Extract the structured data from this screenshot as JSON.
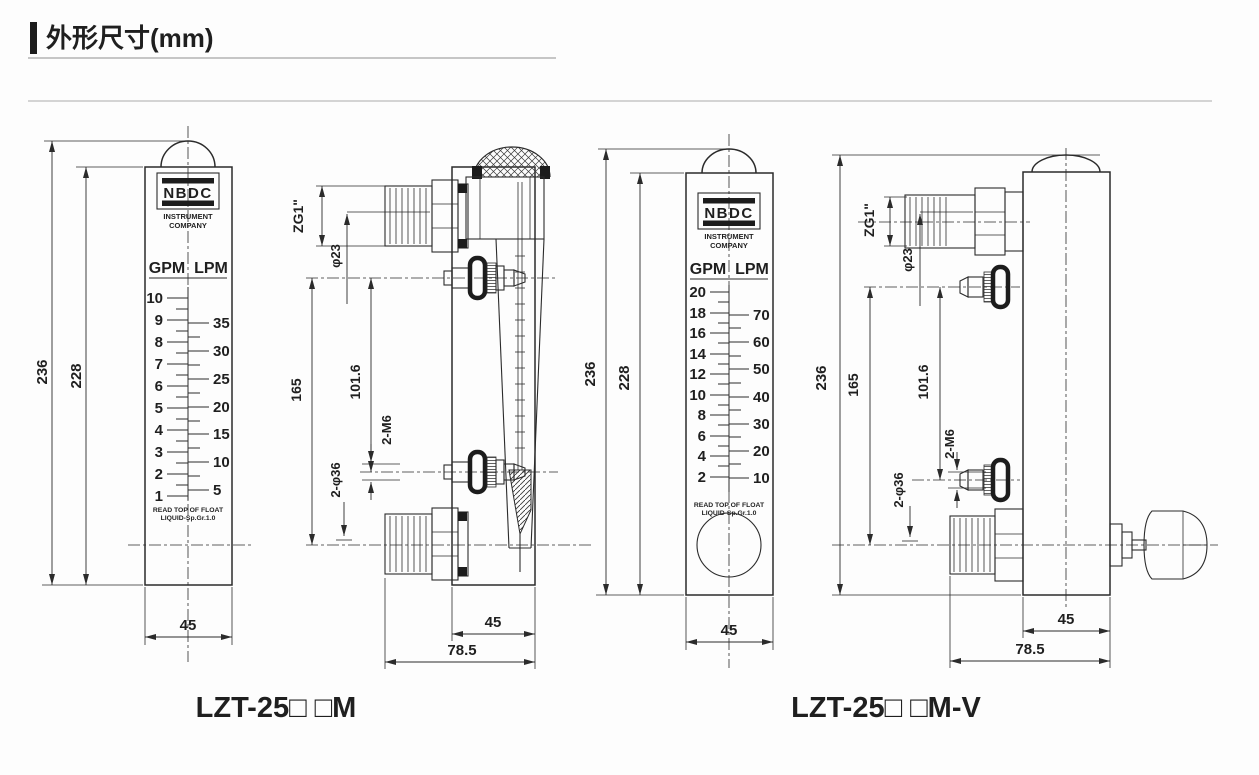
{
  "title": {
    "text": "外形尺寸(mm)"
  },
  "brand": {
    "name": "NBDC",
    "sub1": "INSTRUMENT",
    "sub2": "COMPANY"
  },
  "units": {
    "left": "GPM",
    "right": "LPM"
  },
  "scale_note": {
    "line1": "READ TOP OF FLOAT",
    "line2": "LIQUID-Sp.Gr.1.0"
  },
  "meter_m": {
    "model": "LZT-25□ □M",
    "gpm": [
      "10",
      "9",
      "8",
      "7",
      "6",
      "5",
      "4",
      "3",
      "2",
      "1"
    ],
    "lpm": [
      "35",
      "30",
      "25",
      "20",
      "15",
      "10",
      "5"
    ],
    "front_dims": {
      "total": "236",
      "panel": "228",
      "width": "45"
    },
    "side_dims": {
      "thread": "ZG1\"",
      "bore": "φ23",
      "center_h": "165",
      "mount_pitch": "101.6",
      "mount_thread": "2-M6",
      "flange": "2-φ36",
      "width": "45",
      "depth": "78.5"
    }
  },
  "meter_mv": {
    "model": "LZT-25□ □M-V",
    "gpm": [
      "20",
      "18",
      "16",
      "14",
      "12",
      "10",
      "8",
      "6",
      "4",
      "2"
    ],
    "lpm": [
      "70",
      "60",
      "50",
      "40",
      "30",
      "20",
      "10"
    ],
    "front_dims": {
      "total": "236",
      "panel": "228",
      "width": "45"
    },
    "side_dims": {
      "thread": "ZG1\"",
      "bore": "φ23",
      "center_h": "165",
      "mount_pitch": "101.6",
      "mount_thread": "2-M6",
      "flange": "2-φ36",
      "width": "45",
      "depth": "78.5"
    }
  }
}
